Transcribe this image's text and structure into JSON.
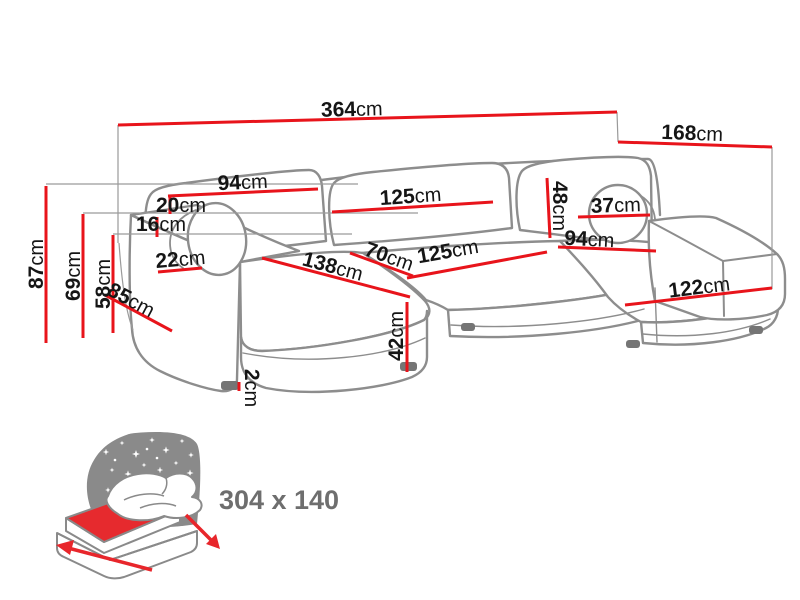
{
  "diagram": {
    "type": "corner-sofa-dimension-diagram",
    "unit": "cm",
    "colors": {
      "dimension_line": "#e8141b",
      "sofa_outline": "#8d8d8d",
      "label_text": "#151515",
      "icon_night_gray": "#8a8a8a",
      "icon_mattress_red": "#e62a2e",
      "sleeping_label_gray": "#6e6e6e"
    },
    "dimensions": {
      "total_width": {
        "value": "364",
        "unit": "cm"
      },
      "total_depth": {
        "value": "168",
        "unit": "cm"
      },
      "back_left_width": {
        "value": "94",
        "unit": "cm"
      },
      "back_center_width": {
        "value": "125",
        "unit": "cm"
      },
      "back_cushion_height": {
        "value": "48",
        "unit": "cm"
      },
      "round_cushion_diameter": {
        "value": "37",
        "unit": "cm"
      },
      "back_gap_top": {
        "value": "20",
        "unit": "cm"
      },
      "back_gap_bottom": {
        "value": "16",
        "unit": "cm"
      },
      "armrest_width": {
        "value": "22",
        "unit": "cm"
      },
      "overall_height": {
        "value": "87",
        "unit": "cm"
      },
      "armrest_height": {
        "value": "69",
        "unit": "cm"
      },
      "seat_back_height": {
        "value": "58",
        "unit": "cm"
      },
      "side_depth": {
        "value": "85",
        "unit": "cm"
      },
      "chaise_left_length": {
        "value": "138",
        "unit": "cm"
      },
      "seat_depth": {
        "value": "70",
        "unit": "cm"
      },
      "seat_width_center": {
        "value": "125",
        "unit": "cm"
      },
      "seat_width_right": {
        "value": "94",
        "unit": "cm"
      },
      "chaise_right_width": {
        "value": "122",
        "unit": "cm"
      },
      "seat_height": {
        "value": "42",
        "unit": "cm"
      },
      "leg_height": {
        "value": "2",
        "unit": "cm"
      }
    },
    "sleeping_area": {
      "label": "304 x 140"
    }
  }
}
